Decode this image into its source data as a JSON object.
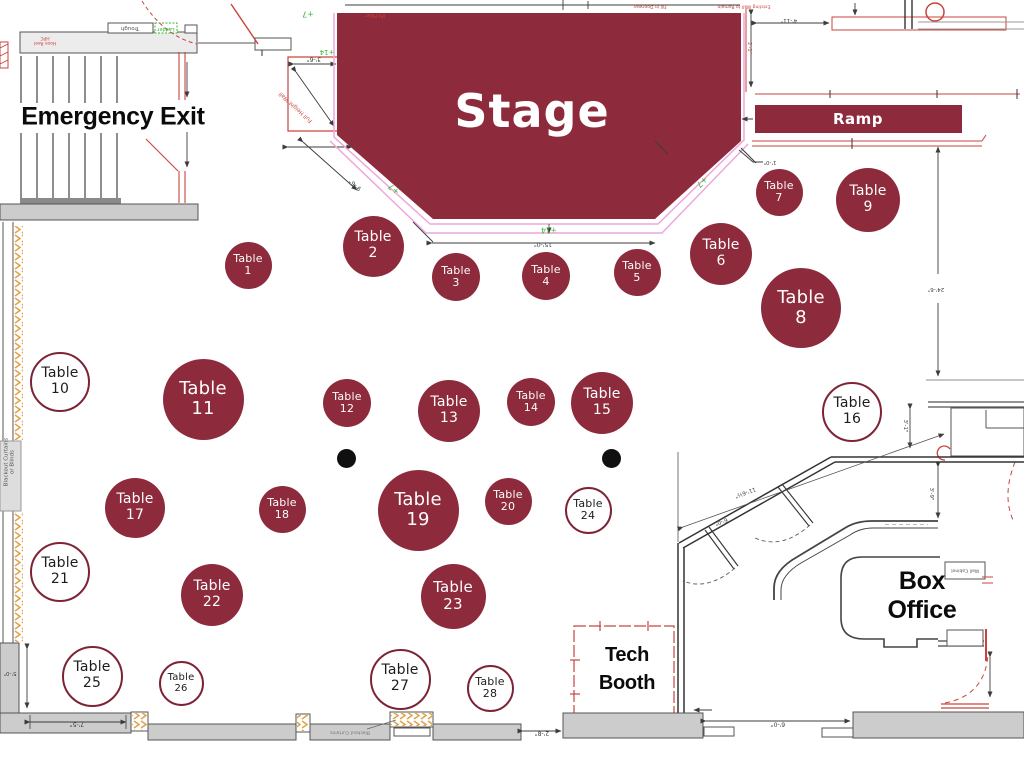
{
  "labels": {
    "stage": "Stage",
    "ramp": "Ramp",
    "emergency_exit": "Emergency Exit",
    "box_office": "Box Office",
    "tech_booth": "Tech\nBooth"
  },
  "table_word": "Table",
  "tables": [
    {
      "number": "1",
      "x": 248,
      "y": 265,
      "d": 47,
      "style": "filled"
    },
    {
      "number": "2",
      "x": 373,
      "y": 246,
      "d": 61,
      "style": "filled"
    },
    {
      "number": "3",
      "x": 456,
      "y": 277,
      "d": 48,
      "style": "filled"
    },
    {
      "number": "4",
      "x": 546,
      "y": 276,
      "d": 48,
      "style": "filled"
    },
    {
      "number": "5",
      "x": 637,
      "y": 272,
      "d": 47,
      "style": "filled"
    },
    {
      "number": "6",
      "x": 721,
      "y": 254,
      "d": 62,
      "style": "filled"
    },
    {
      "number": "7",
      "x": 779,
      "y": 192,
      "d": 47,
      "style": "filled"
    },
    {
      "number": "8",
      "x": 801,
      "y": 308,
      "d": 80,
      "style": "filled"
    },
    {
      "number": "9",
      "x": 868,
      "y": 200,
      "d": 64,
      "style": "filled"
    },
    {
      "number": "10",
      "x": 60,
      "y": 382,
      "d": 60,
      "style": "outline"
    },
    {
      "number": "11",
      "x": 203,
      "y": 399,
      "d": 81,
      "style": "filled"
    },
    {
      "number": "12",
      "x": 347,
      "y": 403,
      "d": 48,
      "style": "filled"
    },
    {
      "number": "13",
      "x": 449,
      "y": 411,
      "d": 62,
      "style": "filled"
    },
    {
      "number": "14",
      "x": 531,
      "y": 402,
      "d": 48,
      "style": "filled"
    },
    {
      "number": "15",
      "x": 602,
      "y": 403,
      "d": 62,
      "style": "filled"
    },
    {
      "number": "16",
      "x": 852,
      "y": 412,
      "d": 60,
      "style": "outline"
    },
    {
      "number": "17",
      "x": 135,
      "y": 508,
      "d": 60,
      "style": "filled"
    },
    {
      "number": "18",
      "x": 282,
      "y": 509,
      "d": 47,
      "style": "filled"
    },
    {
      "number": "19",
      "x": 418,
      "y": 510,
      "d": 81,
      "style": "filled"
    },
    {
      "number": "20",
      "x": 508,
      "y": 501,
      "d": 47,
      "style": "filled"
    },
    {
      "number": "21",
      "x": 60,
      "y": 572,
      "d": 60,
      "style": "outline"
    },
    {
      "number": "22",
      "x": 212,
      "y": 595,
      "d": 62,
      "style": "filled"
    },
    {
      "number": "23",
      "x": 453,
      "y": 596,
      "d": 65,
      "style": "filled"
    },
    {
      "number": "24",
      "x": 588,
      "y": 510,
      "d": 47,
      "style": "outline"
    },
    {
      "number": "25",
      "x": 92,
      "y": 676,
      "d": 61,
      "style": "outline"
    },
    {
      "number": "26",
      "x": 181,
      "y": 683,
      "d": 45,
      "style": "outline"
    },
    {
      "number": "27",
      "x": 400,
      "y": 679,
      "d": 61,
      "style": "outline"
    },
    {
      "number": "28",
      "x": 490,
      "y": 688,
      "d": 47,
      "style": "outline"
    }
  ],
  "black_dots": [
    {
      "x": 346,
      "y": 458,
      "d": 19
    },
    {
      "x": 611,
      "y": 458,
      "d": 19
    }
  ],
  "annotations": [
    {
      "text": "+7",
      "x": 308,
      "y": 14,
      "rot": 180,
      "size": 8,
      "color": "#2eb82e"
    },
    {
      "text": "+14",
      "x": 327,
      "y": 52,
      "rot": 180,
      "size": 7,
      "color": "#2eb82e"
    },
    {
      "text": "+7",
      "x": 394,
      "y": 189,
      "rot": 222,
      "size": 8,
      "color": "#2eb82e"
    },
    {
      "text": "+7",
      "x": 702,
      "y": 182,
      "rot": 138,
      "size": 8,
      "color": "#2eb82e"
    },
    {
      "text": "+14",
      "x": 549,
      "y": 229,
      "rot": 180,
      "size": 7.5,
      "color": "#2eb82e"
    },
    {
      "text": "15'-0\"",
      "x": 543,
      "y": 243,
      "rot": 180,
      "size": 6,
      "color": "#3c3c3c"
    },
    {
      "text": "3'-6\"",
      "x": 314,
      "y": 58,
      "rot": 180,
      "size": 6,
      "color": "#3c3c3c"
    },
    {
      "text": "9'-6\"",
      "x": 356,
      "y": 184,
      "rot": 222,
      "size": 6,
      "color": "#3c3c3c"
    },
    {
      "text": "Full Height Wall",
      "x": 296,
      "y": 107,
      "rot": 222,
      "size": 5.5,
      "color": "#c9433c"
    },
    {
      "text": "Pit Filler",
      "x": 375,
      "y": 14,
      "rot": 180,
      "size": 5,
      "color": "#c9433c"
    },
    {
      "text": "Fill in Doorway",
      "x": 650,
      "y": 6,
      "rot": 180,
      "size": 4.5,
      "color": "#c9433c"
    },
    {
      "text": "Existing Wall to Remain",
      "x": 744,
      "y": 6,
      "rot": 180,
      "size": 4.5,
      "color": "#c9433c"
    },
    {
      "text": "2'-1\"",
      "x": 748,
      "y": 48,
      "rot": 90,
      "size": 5,
      "color": "#c9433c"
    },
    {
      "text": "4'-11\"",
      "x": 789,
      "y": 20,
      "rot": 180,
      "size": 5.5,
      "color": "#3c3c3c"
    },
    {
      "text": "1'-0\"",
      "x": 770,
      "y": 162,
      "rot": 180,
      "size": 5.5,
      "color": "#3c3c3c"
    },
    {
      "text": "24'-6\"",
      "x": 936,
      "y": 289,
      "rot": 180,
      "size": 5.5,
      "color": "#3c3c3c"
    },
    {
      "text": "3'-1\"",
      "x": 905,
      "y": 426,
      "rot": 90,
      "size": 5.5,
      "color": "#3c3c3c"
    },
    {
      "text": "3'-9\"",
      "x": 931,
      "y": 494,
      "rot": 90,
      "size": 5.5,
      "color": "#3c3c3c"
    },
    {
      "text": "11'-6½\"",
      "x": 745,
      "y": 492,
      "rot": 160,
      "size": 5.5,
      "color": "#3c3c3c"
    },
    {
      "text": "6'-0\"",
      "x": 721,
      "y": 521,
      "rot": 160,
      "size": 5.5,
      "color": "#3c3c3c"
    },
    {
      "text": "2'-8\"",
      "x": 542,
      "y": 732,
      "rot": 180,
      "size": 6,
      "color": "#3c3c3c"
    },
    {
      "text": "6'-0\"",
      "x": 778,
      "y": 723,
      "rot": 180,
      "size": 6,
      "color": "#3c3c3c"
    },
    {
      "text": "7'-5\"",
      "x": 77,
      "y": 723,
      "rot": 180,
      "size": 6,
      "color": "#3c3c3c"
    },
    {
      "text": "5'-0\"",
      "x": 10,
      "y": 673,
      "rot": 180,
      "size": 5.5,
      "color": "#3c3c3c"
    },
    {
      "text": "Blackout Curtains",
      "x": 350,
      "y": 732,
      "rot": 180,
      "size": 4.5,
      "color": "#777777"
    },
    {
      "text": "Trough",
      "x": 130,
      "y": 28,
      "rot": 180,
      "size": 5.5,
      "color": "#555555"
    },
    {
      "text": "Ladder",
      "x": 166,
      "y": 28,
      "rot": 180,
      "size": 5,
      "color": "#2eb82e"
    },
    {
      "text": "Hose Reel\nHPC",
      "x": 45,
      "y": 40,
      "rot": 180,
      "size": 4.5,
      "color": "#c9433c"
    },
    {
      "text": "Wall Cabinet",
      "x": 965,
      "y": 570,
      "rot": 180,
      "size": 4.5,
      "color": "#555555"
    },
    {
      "text": "Blackout Curtains\nor Blinds",
      "x": 10,
      "y": 462,
      "rot": -90,
      "size": 5.5,
      "color": "#555555"
    }
  ],
  "colors": {
    "maroon": "#8d2b3c",
    "maroon-dark": "#7c2335",
    "pink": "#eda7dc",
    "green": "#2eb82e",
    "red": "#c9433c",
    "wall-gray": "#cccccc",
    "hatch-orange": "#e2a24a",
    "line-dark": "#3c3c3c"
  }
}
